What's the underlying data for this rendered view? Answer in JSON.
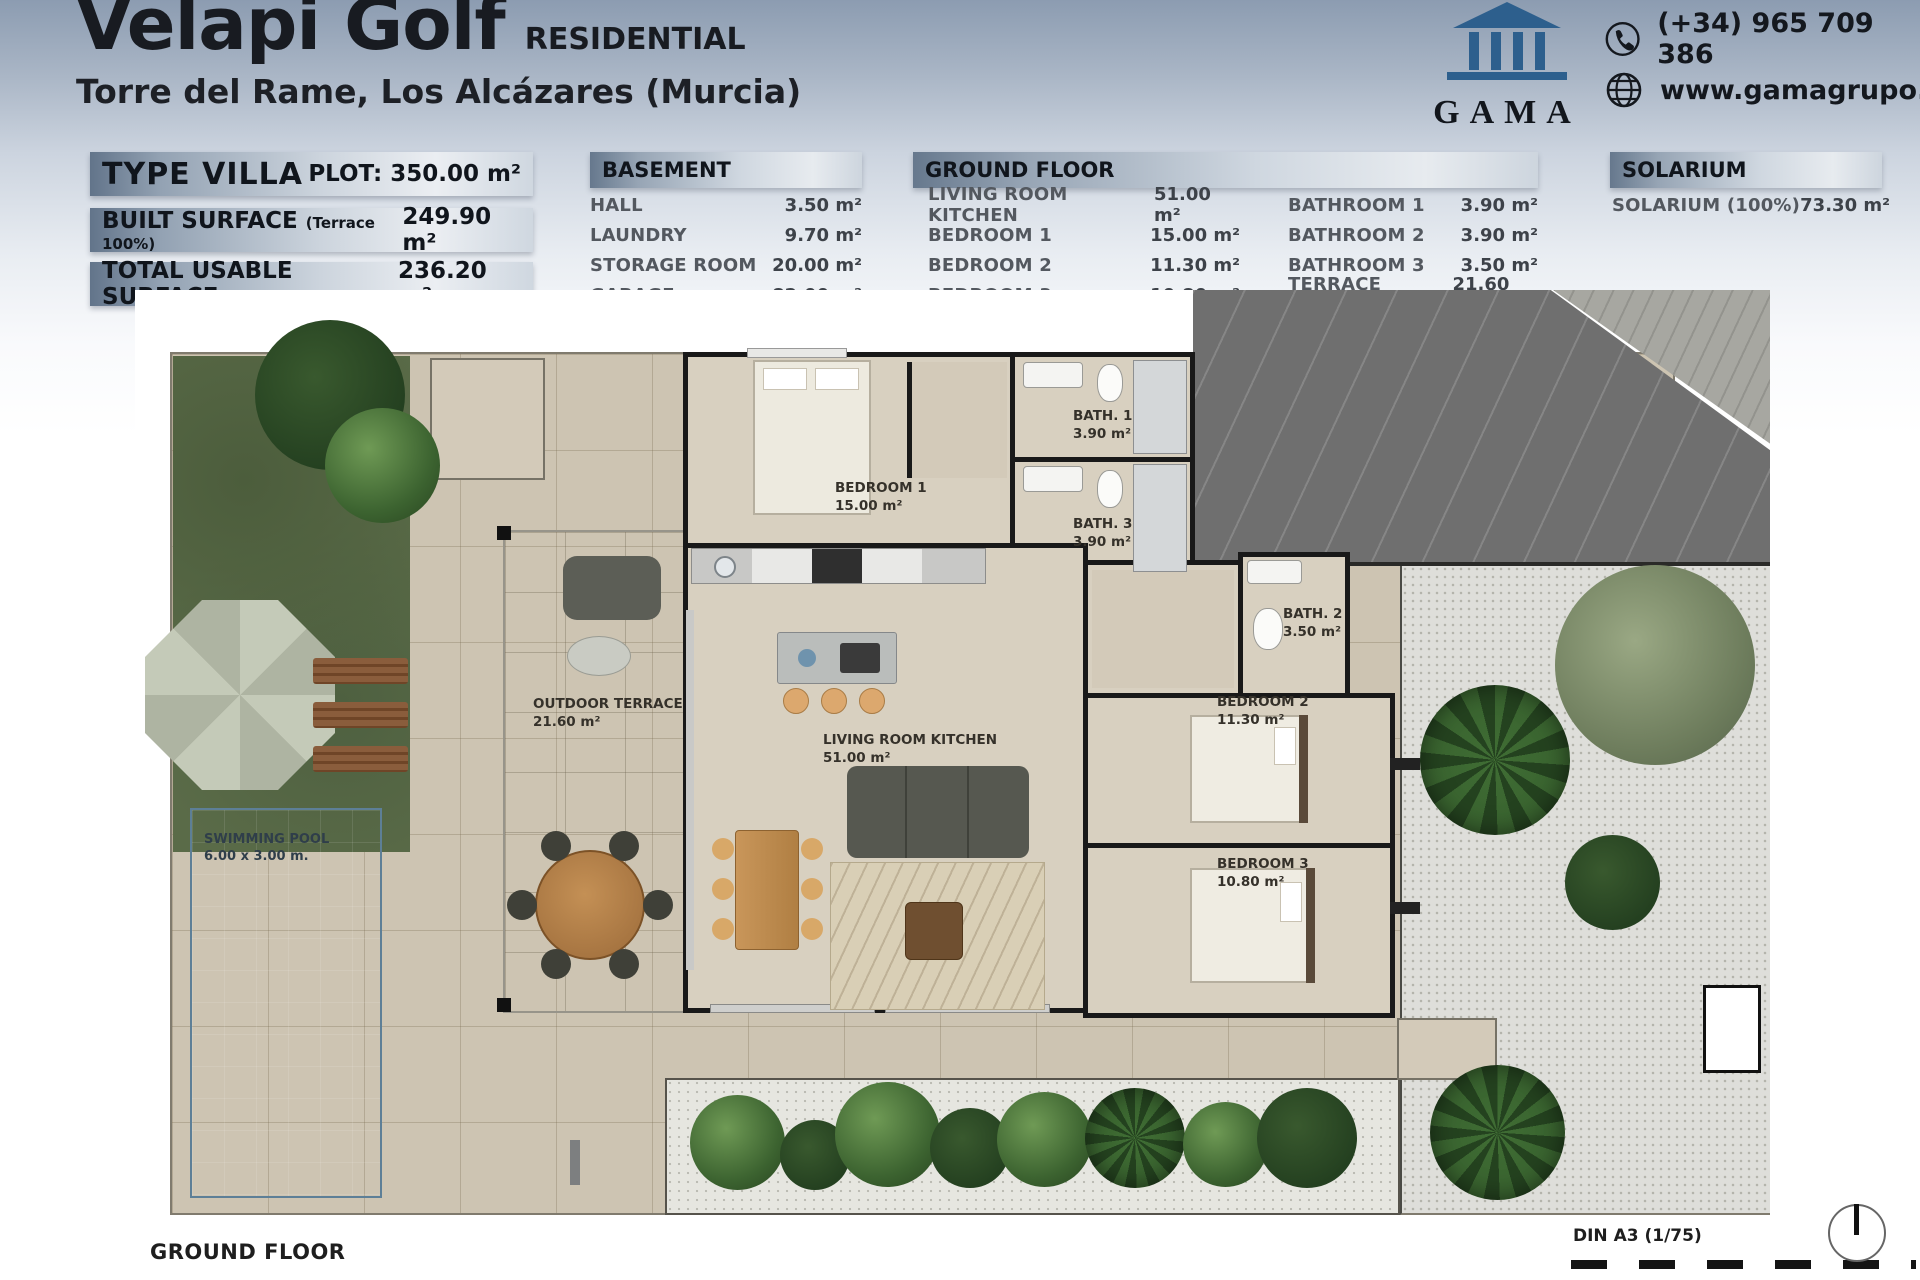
{
  "header": {
    "title": "Velapi Golf",
    "title_tag": "RESIDENTIAL",
    "subtitle": "Torre del Rame, Los Alcázares (Murcia)",
    "logo_text": "GAMA",
    "phone": "(+34) 965 709 386",
    "website": "www.gamagrupo.es"
  },
  "summary": {
    "type_row": {
      "label": "TYPE VILLA",
      "value": "PLOT: 350.00 m²"
    },
    "built_row": {
      "label": "BUILT SURFACE",
      "note": "(Terrace 100%)",
      "value": "249.90 m²"
    },
    "usable_row": {
      "label": "TOTAL USABLE SURFACE",
      "value": "236.20 m²"
    }
  },
  "basement": {
    "title": "BASEMENT",
    "rows": [
      {
        "label": "HALL",
        "value": "3.50 m²"
      },
      {
        "label": "LAUNDRY",
        "value": "9.70 m²"
      },
      {
        "label": "STORAGE ROOM",
        "value": "20.00 m²"
      },
      {
        "label": "GARAGE",
        "value": "82.00 m²"
      }
    ]
  },
  "ground_floor": {
    "title": "GROUND FLOOR",
    "left_rows": [
      {
        "label": "LIVING ROOM KITCHEN",
        "value": "51.00 m²"
      },
      {
        "label": "BEDROOM 1",
        "value": "15.00 m²"
      },
      {
        "label": "BEDROOM 2",
        "value": "11.30 m²"
      },
      {
        "label": "BEDROOM 3",
        "value": "10.80 m²"
      }
    ],
    "right_rows": [
      {
        "label": "BATHROOM 1",
        "value": "3.90 m²"
      },
      {
        "label": "BATHROOM 2",
        "value": "3.90 m²"
      },
      {
        "label": "BATHROOM 3",
        "value": "3.50 m²"
      },
      {
        "label": "TERRACE (100%)",
        "value": "21.60 m²"
      }
    ]
  },
  "solarium": {
    "title": "SOLARIUM",
    "row": {
      "label": "SOLARIUM (100%)",
      "value": "73.30 m²"
    }
  },
  "plan": {
    "rooms": {
      "bedroom1": {
        "name": "BEDROOM 1",
        "area": "15.00 m²"
      },
      "bath1": {
        "name": "BATH. 1",
        "area": "3.90 m²"
      },
      "bath3": {
        "name": "BATH. 3",
        "area": "3.90 m²"
      },
      "bath2": {
        "name": "BATH. 2",
        "area": "3.50 m²"
      },
      "bedroom2": {
        "name": "BEDROOM 2",
        "area": "11.30 m²"
      },
      "bedroom3": {
        "name": "BEDROOM 3",
        "area": "10.80 m²"
      },
      "terrace": {
        "name": "OUTDOOR TERRACE",
        "area": "21.60 m²"
      },
      "living": {
        "name": "LIVING ROOM KITCHEN",
        "area": "51.00 m²"
      },
      "pool": {
        "name": "SWIMMING POOL",
        "size": "6.00 x 3.00 m."
      }
    },
    "caption": "GROUND FLOOR",
    "sheet": "DIN A3 (1/75)"
  },
  "colors": {
    "brand_blue": "#2d5f8d",
    "wall": "#191919",
    "pool": "#7fa5c1",
    "grass": "#5a6b48",
    "paving": "#cdc4b2",
    "driveway": "#6f6f6f"
  }
}
